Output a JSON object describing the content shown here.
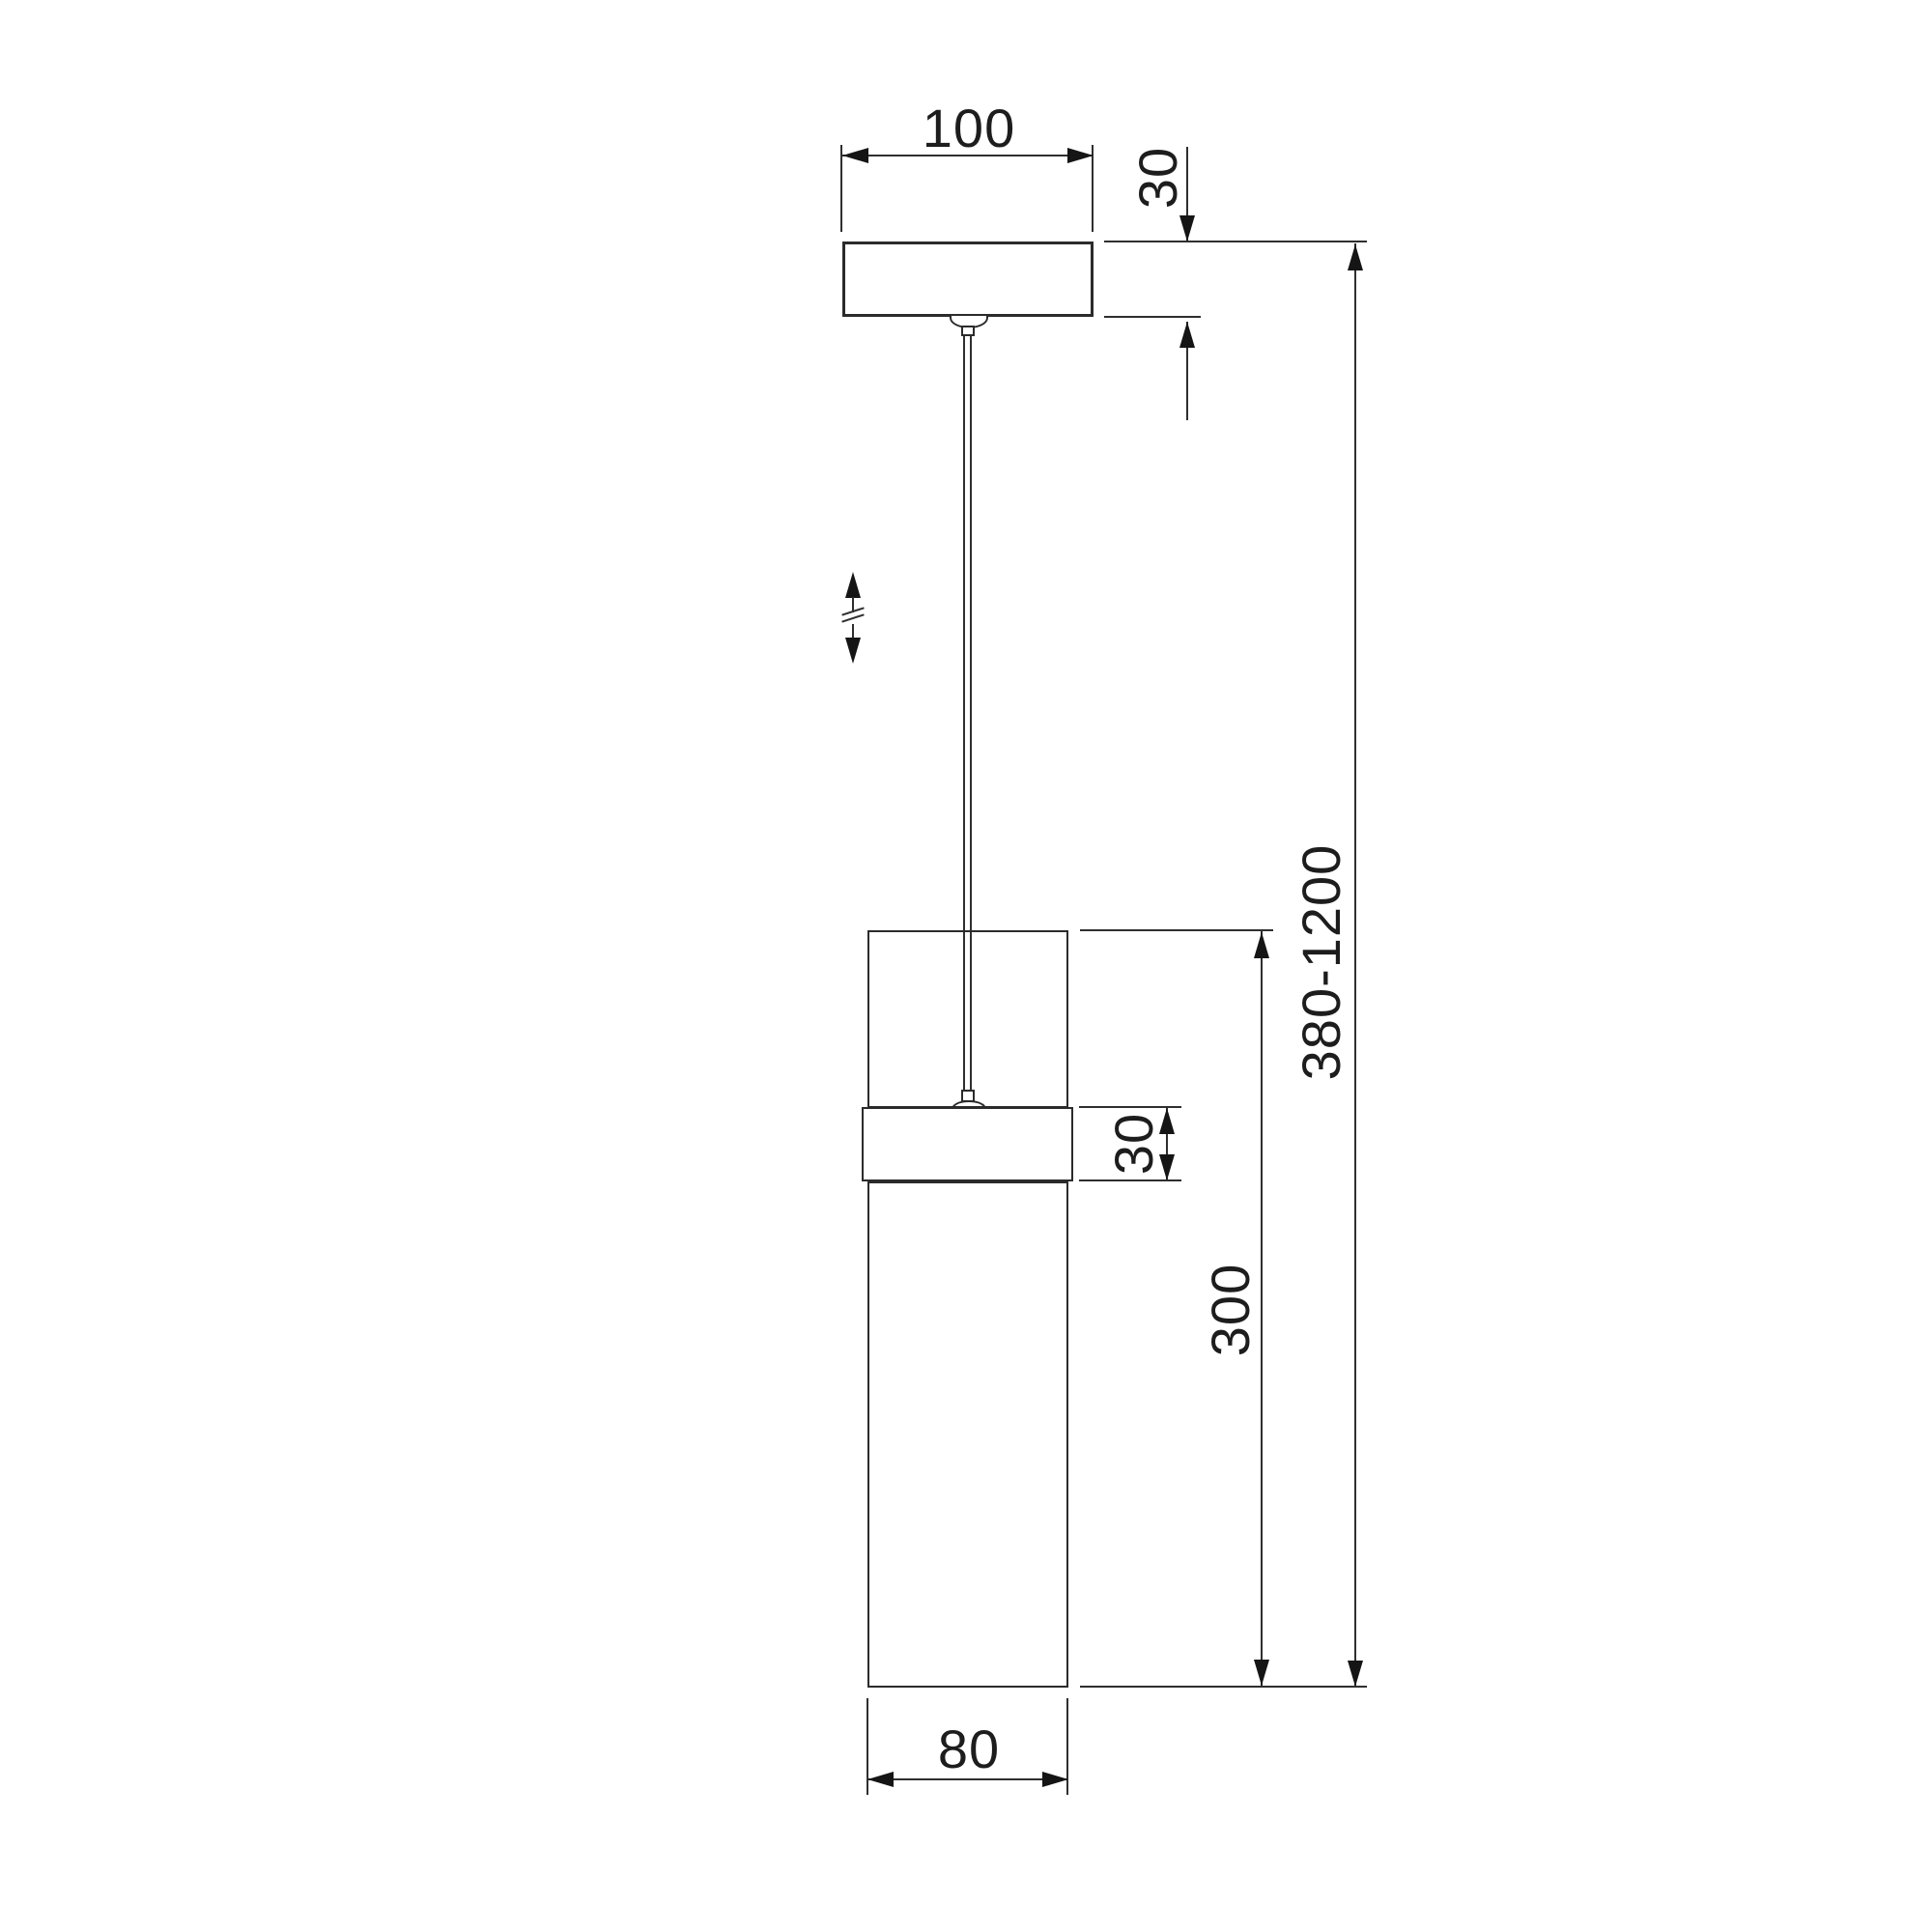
{
  "drawing": {
    "title": "pendant-lamp-dimension-drawing",
    "colors": {
      "background": "#ffffff",
      "line": "#2f2f2f",
      "arrow": "#151515",
      "text": "#1d1d1d"
    },
    "dimensions": {
      "canopy_width": "100",
      "canopy_height": "30",
      "overall_height": "380-1200",
      "shade_height": "300",
      "ring_height": "30",
      "shade_diameter": "80"
    }
  }
}
